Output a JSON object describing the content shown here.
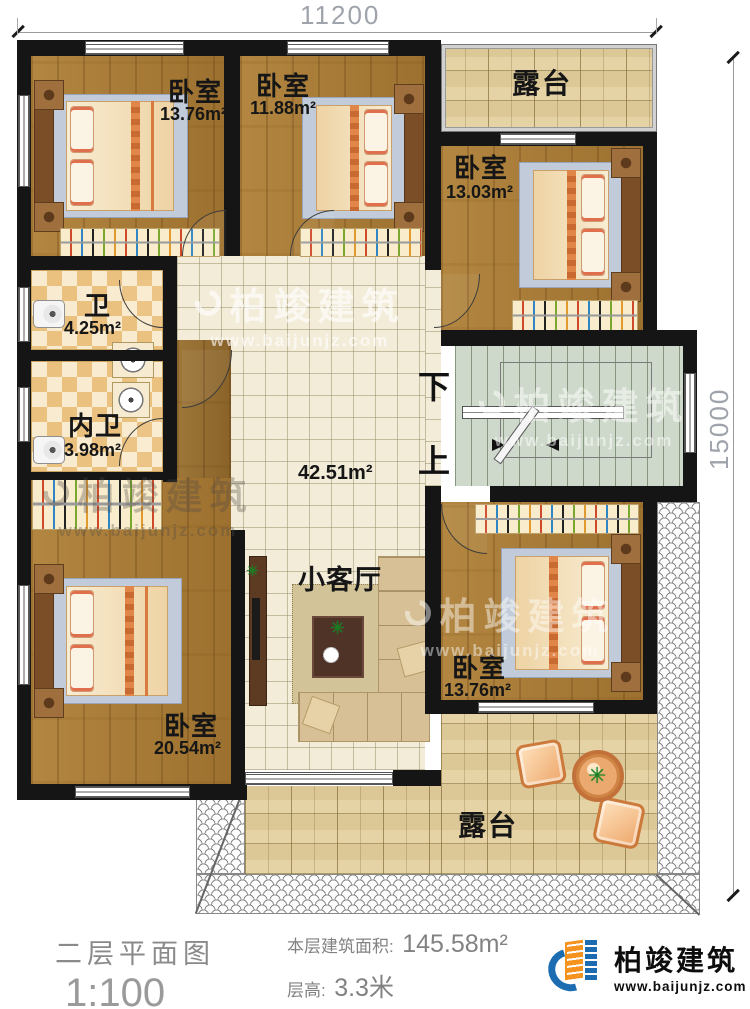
{
  "dimensions": {
    "top": "11200",
    "right": "15000"
  },
  "rooms": {
    "bedroom_top_left": {
      "label": "卧室",
      "area": "13.76m²"
    },
    "bedroom_top_middle": {
      "label": "卧室",
      "area": "11.88m²"
    },
    "terrace_top": {
      "label": "露台"
    },
    "bedroom_right": {
      "label": "卧室",
      "area": "13.03m²"
    },
    "bathroom": {
      "label": "卫",
      "area": "4.25m²"
    },
    "inner_bathroom": {
      "label": "内卫",
      "area": "3.98m²"
    },
    "hall": {
      "area": "42.51m²"
    },
    "living_room": {
      "label": "小客厅"
    },
    "bedroom_bottom_right": {
      "label": "卧室",
      "area": "13.76m²"
    },
    "bedroom_bottom_left": {
      "label": "卧室",
      "area": "20.54m²"
    },
    "terrace_bottom": {
      "label": "露台"
    }
  },
  "stairs": {
    "down": "下",
    "up": "上"
  },
  "title_block": {
    "drawing_title": "二层平面图",
    "scale": "1:100",
    "area_label": "本层建筑面积:",
    "area_value": "145.58m²",
    "floor_height_label": "层高:",
    "floor_height_value": "3.3米"
  },
  "branding": {
    "company": "柏竣建筑",
    "website": "www.baijunjz.com"
  },
  "watermark": {
    "company": "柏竣建筑",
    "website": "www.baijunjz.com"
  },
  "icons": {
    "plant": "✳"
  },
  "colors": {
    "wall": "#151515",
    "wood_floor": "#a87b35",
    "hall_tile": "#f2ecd9",
    "terrace_tile": "#dcc897",
    "stair_floor": "#ced8cb",
    "checker_tile": "#eac17f",
    "brand_blue": "#1b6cb0",
    "brand_orange": "#f6921e"
  }
}
